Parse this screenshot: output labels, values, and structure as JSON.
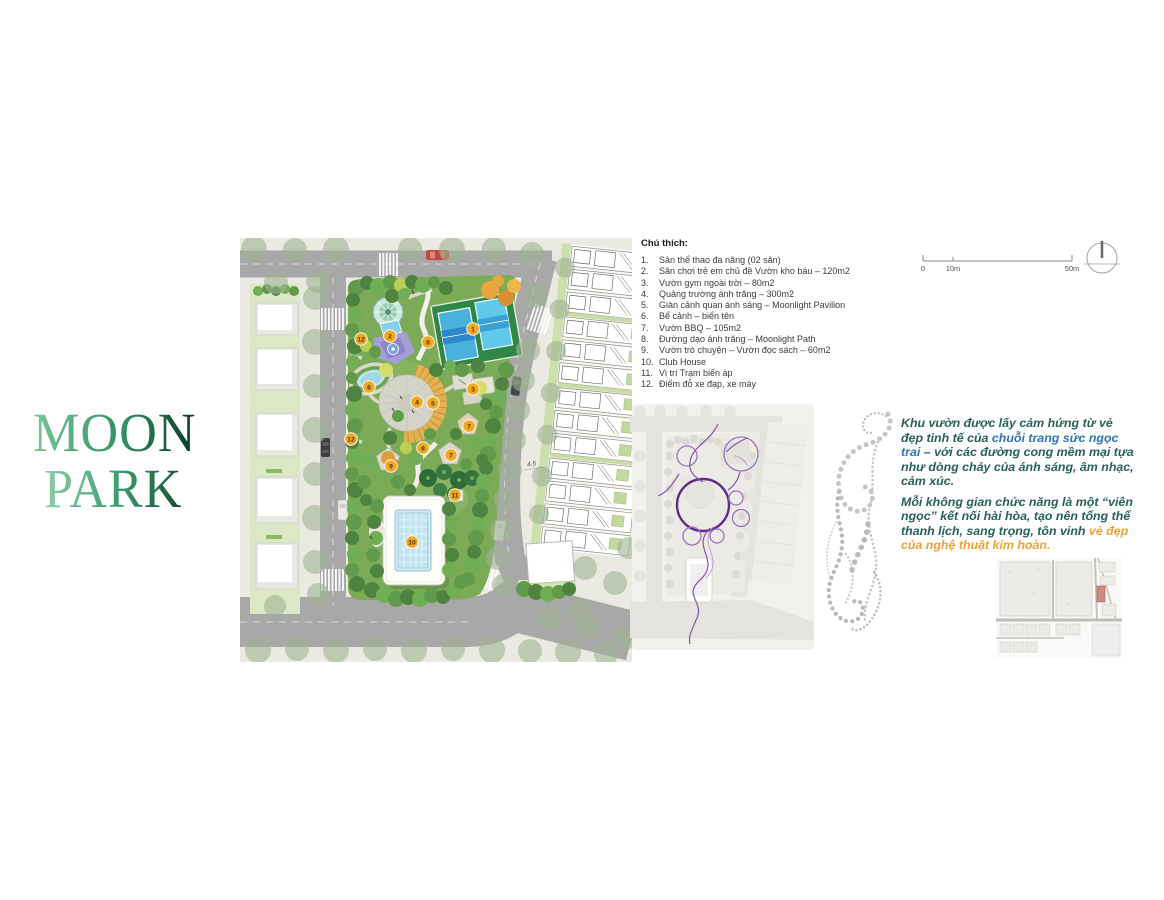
{
  "logo": {
    "line1": "MOON",
    "line2": "PARK"
  },
  "legend": {
    "title": "Chú thích:",
    "items": [
      {
        "num": "1.",
        "text": "Sân thể thao đa năng (02 sân)"
      },
      {
        "num": "2.",
        "text": "Sân chơi trẻ em chủ đề Vườn kho báu – 120m2"
      },
      {
        "num": "3.",
        "text": "Vườn gym ngoài trời – 80m2"
      },
      {
        "num": "4.",
        "text": "Quảng trường ánh trăng – 300m2"
      },
      {
        "num": "5.",
        "text": "Giàn cảnh quan ánh sáng – Moonlight Pavilion"
      },
      {
        "num": "6.",
        "text": "Bể cảnh – biển tên"
      },
      {
        "num": "7.",
        "text": "Vườn BBQ – 105m2"
      },
      {
        "num": "8.",
        "text": "Đường dạo ánh trăng – Moonlight Path"
      },
      {
        "num": "9.",
        "text": "Vườn trò chuyện – Vườn đọc sách – 60m2"
      },
      {
        "num": "10.",
        "text": "Club House"
      },
      {
        "num": "11.",
        "text": "Vị trí Trạm biến áp"
      },
      {
        "num": "12.",
        "text": "Điểm đỗ xe đạp, xe máy"
      }
    ]
  },
  "site_plan": {
    "markers": [
      "1",
      "2",
      "3",
      "4",
      "5",
      "6",
      "7",
      "7",
      "8",
      "8",
      "9",
      "10",
      "11",
      "12",
      "12"
    ],
    "dimension_label": "4.5"
  },
  "scale_bar": {
    "tick0": "0",
    "tick1": "10m",
    "tick2": "50m"
  },
  "concept_text": {
    "p1_before": "Khu vườn được lấy cảm hứng từ vẻ đẹp tinh tế của ",
    "p1_highlight": "chuỗi trang sức ngọc trai",
    "p1_after": " – với các đường cong mềm mại tựa như dòng chảy của ánh sáng, âm nhạc, cảm xúc.",
    "p2_before": "Mỗi không gian chức năng là một “viên ngọc” kết nối hài hòa, tạo nên tổng thể thanh lịch, sang trọng, tôn vinh ",
    "p2_highlight": "vẻ đẹp của nghệ thuật kim hoàn."
  },
  "colors": {
    "marker": "#f3a81f",
    "concept_body": "#27615a",
    "highlight_blue": "#2e75b6",
    "highlight_orange": "#f0a132",
    "road": "#a8a8a8",
    "park_green": "#7cab58",
    "purple_accent": "#5e2c87",
    "logo_green_dark": "#0b3424",
    "logo_green_light": "#7cc79b"
  }
}
